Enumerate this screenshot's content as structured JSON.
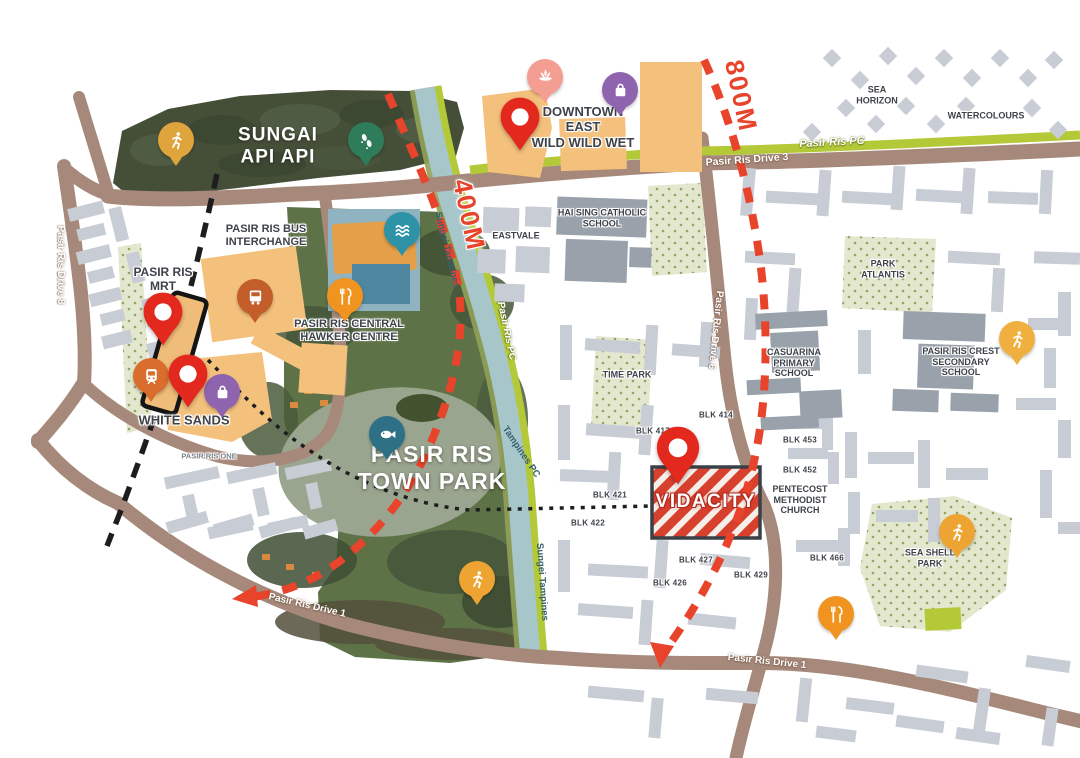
{
  "site": {
    "label": "VIDACITY"
  },
  "distances": {
    "d400": "400M",
    "d800": "800M"
  },
  "places": {
    "sungai_api_api": {
      "l1": "SUNGAI",
      "l2": "API API"
    },
    "town_park": {
      "l1": "PASIR RIS",
      "l2": "TOWN PARK"
    },
    "downtown_east": {
      "l1": "DOWNTOWN",
      "l2": "EAST",
      "l3": "WILD WILD WET"
    },
    "bus_interchange": {
      "l1": "PASIR RIS BUS",
      "l2": "INTERCHANGE"
    },
    "mrt": {
      "l1": "PASIR RIS",
      "l2": "MRT"
    },
    "white_sands": "WHITE SANDS",
    "pasir_ris_one": "PASIR RIS ONE",
    "hawker": {
      "l1": "PASIR RIS CENTRAL",
      "l2": "HAWKER CENTRE"
    },
    "eastvale": "EASTVALE",
    "hai_sing": {
      "l1": "HAI SING CATHOLIC",
      "l2": "SCHOOL"
    },
    "sea_horizon": {
      "l1": "SEA",
      "l2": "HORIZON"
    },
    "watercolours": "WATERCOLOURS",
    "park_atlantis": {
      "l1": "PARK",
      "l2": "ATLANTIS"
    },
    "casuarina": {
      "l1": "CASUARINA",
      "l2": "PRIMARY",
      "l3": "SCHOOL"
    },
    "crest": {
      "l1": "PASIR RIS CREST",
      "l2": "SECONDARY",
      "l3": "SCHOOL"
    },
    "time_park": "TIME PARK",
    "pentecost": {
      "l1": "PENTECOST",
      "l2": "METHODIST",
      "l3": "CHURCH"
    },
    "sea_shell": {
      "l1": "SEA SHELL",
      "l2": "PARK"
    }
  },
  "blocks": {
    "b414": "BLK 414",
    "b417": "BLK 417",
    "b421": "BLK 421",
    "b422": "BLK 422",
    "b426": "BLK 426",
    "b427": "BLK 427",
    "b429": "BLK 429",
    "b452": "BLK 452",
    "b453": "BLK 453",
    "b466": "BLK 466"
  },
  "roads": {
    "drive8": "Pasir Ris Drive 8",
    "drive3": "Pasir Ris Drive 3",
    "drive6": "Pasir Ris Drive 6",
    "drive1_west": "Pasir Ris Drive 1",
    "drive1_east": "Pasir Ris Drive 1",
    "pc_top": "Pasir Ris PC",
    "pc_mid": "Pasir Ris PC"
  },
  "waterways": {
    "sungai_tampines": "Sungai Tampines",
    "tampines_pc": "Tampines PC",
    "sungei_tampines": "Sungei Tampines"
  },
  "markers": {
    "runner_api": {
      "icon": "runner-icon",
      "color": "#dfa53c"
    },
    "footprints": {
      "icon": "footprints-icon",
      "color": "#2f7c5b"
    },
    "spa": {
      "icon": "lotus-icon",
      "color": "#f49d93"
    },
    "bag_downtown": {
      "icon": "shopping-bag-icon",
      "color": "#8f64ae"
    },
    "red_downtown": {
      "icon": "location-pin-icon",
      "color": "#e3281e"
    },
    "pool": {
      "icon": "waves-icon",
      "color": "#2f93a8"
    },
    "food_hawker": {
      "icon": "cutlery-icon",
      "color": "#f0941f"
    },
    "red_mrt": {
      "icon": "location-pin-icon",
      "color": "#e3281e"
    },
    "train": {
      "icon": "train-icon",
      "color": "#d96d2e"
    },
    "red_white_sands": {
      "icon": "location-pin-icon",
      "color": "#e3281e"
    },
    "bag_white_sands": {
      "icon": "shopping-bag-icon",
      "color": "#8f64ae"
    },
    "bus": {
      "icon": "bus-icon",
      "color": "#c35d2a"
    },
    "fish": {
      "icon": "fish-icon",
      "color": "#2e7086"
    },
    "runner_park": {
      "icon": "runner-icon",
      "color": "#eda433"
    },
    "red_vidacity": {
      "icon": "location-pin-icon",
      "color": "#e3281e"
    },
    "runner_crest": {
      "icon": "runner-icon",
      "color": "#efb040"
    },
    "runner_shell": {
      "icon": "runner-icon",
      "color": "#eda433"
    },
    "food_se": {
      "icon": "cutlery-icon",
      "color": "#f0941f"
    }
  },
  "colors": {
    "road": "#a6897b",
    "park_connector": "#b4c937",
    "river": "#a7c6ca",
    "forest": "#454f38",
    "park": "#5e7248",
    "building": "#c8cdd5",
    "school_building": "#99a1ab",
    "landmark_building": "#f4c17d",
    "route_red": "#e8432b",
    "site_red": "#d8402e",
    "rail_black": "#1d1d1d"
  }
}
